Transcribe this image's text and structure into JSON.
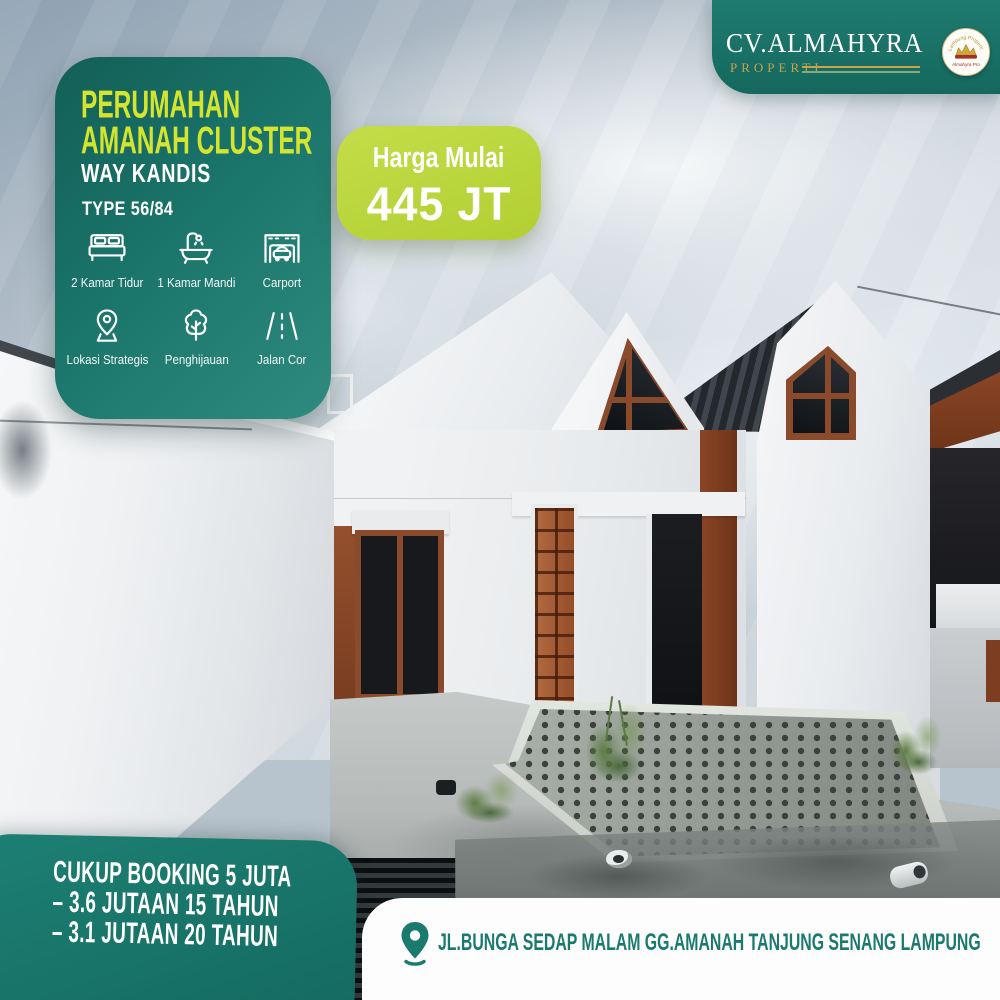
{
  "brand": {
    "name": "CV.ALMAHYRA",
    "division": "PROPERTI",
    "logo": {
      "arc_top": "Lampung Properti",
      "bottom_text": "Almahyra Pro"
    }
  },
  "listing_card": {
    "title_line1": "PERUMAHAN",
    "title_line2": "AMANAH CLUSTER",
    "location": "WAY KANDIS",
    "type_label": "TYPE 56/84",
    "features": [
      {
        "icon": "bed-icon",
        "label": "2 Kamar Tidur"
      },
      {
        "icon": "bathtub-icon",
        "label": "1 Kamar Mandi"
      },
      {
        "icon": "carport-icon",
        "label": "Carport"
      },
      {
        "icon": "map-pin-icon",
        "label": "Lokasi Strategis"
      },
      {
        "icon": "tree-icon",
        "label": "Penghijauan"
      },
      {
        "icon": "road-icon",
        "label": "Jalan Cor"
      }
    ]
  },
  "price_badge": {
    "label": "Harga Mulai",
    "value": "445 JT"
  },
  "booking_badge": {
    "lines": [
      "CUKUP BOOKING 5 JUTA",
      "– 3.6 JUTAAN 15 TAHUN",
      "– 3.1 JUTAAN 20 TAHUN"
    ]
  },
  "address_bar": {
    "icon": "location-pin-icon",
    "text": "JL.BUNGA SEDAP MALAM GG.AMANAH TANJUNG SENANG LAMPUNG"
  },
  "colors": {
    "teal": "#15685e",
    "teal_light": "#2e8b7e",
    "lime": "#b5d23a",
    "title_yellow": "#d5e52f",
    "gold": "#c9a24a",
    "address_teal": "#1a7a6e",
    "terracotta": "#8a4a2c"
  }
}
